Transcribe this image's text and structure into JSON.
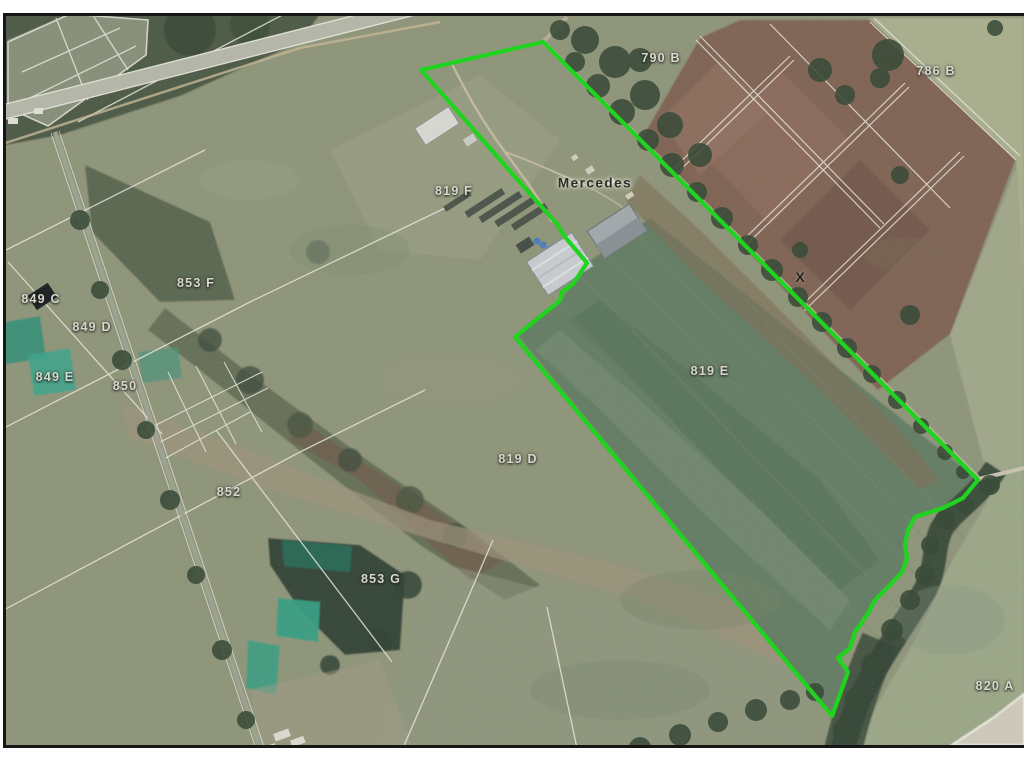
{
  "page": {
    "background_color": "#ffffff",
    "frame_border_color": "#161616"
  },
  "map": {
    "type": "satellite-parcel-map",
    "place_label": "Mercedes",
    "place_label_pos": {
      "x": 595,
      "y": 183
    },
    "place_label_color": "#2e2e28",
    "marker_x_label": "X",
    "marker_pos": {
      "x": 800,
      "y": 277
    },
    "marker_color": "#23231d",
    "parcel_label_color": "#d8d8cd",
    "parcel_labels": [
      {
        "text": "790 B",
        "x": 661,
        "y": 58
      },
      {
        "text": "786 B",
        "x": 936,
        "y": 71
      },
      {
        "text": "819 F",
        "x": 454,
        "y": 191
      },
      {
        "text": "853 F",
        "x": 196,
        "y": 283
      },
      {
        "text": "849 C",
        "x": 41,
        "y": 299
      },
      {
        "text": "849 D",
        "x": 92,
        "y": 327
      },
      {
        "text": "849 E",
        "x": 55,
        "y": 377
      },
      {
        "text": "850",
        "x": 125,
        "y": 386
      },
      {
        "text": "852",
        "x": 229,
        "y": 492
      },
      {
        "text": "819 E",
        "x": 710,
        "y": 371
      },
      {
        "text": "819 D",
        "x": 518,
        "y": 459
      },
      {
        "text": "853 G",
        "x": 381,
        "y": 579
      },
      {
        "text": "820 A",
        "x": 995,
        "y": 686
      }
    ],
    "highlight_outline": {
      "color": "#1fd31f",
      "points": "421,70 543,42 978,480 963,498 943,508 915,517 908,530 905,545 907,558 902,572 890,585 875,600 867,615 855,632 850,648 838,658 848,672 832,716 515,337 557,303 560,300 562,292 573,284 587,263 565,237 557,224 516,178 467,122"
    }
  }
}
